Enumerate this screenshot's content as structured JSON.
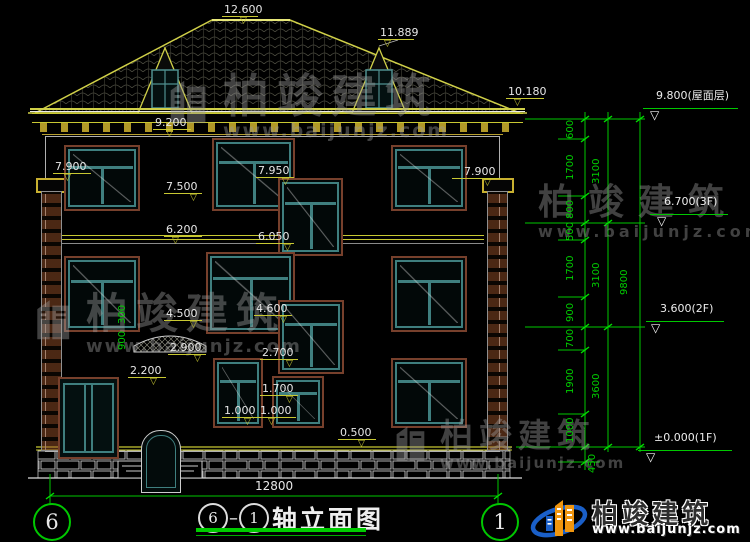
{
  "title": {
    "axis_left": "6",
    "axis_right": "1",
    "text": "轴立面图"
  },
  "bottom_dim": "12800",
  "axes": {
    "left": "6",
    "right": "1"
  },
  "watermark": {
    "brand": "柏竣建筑",
    "url": "www.baijunjz.com"
  },
  "logo": {
    "brand": "柏竣建筑",
    "url": "www.baijunjz.com"
  },
  "facade_marks": [
    {
      "v": "12.600",
      "x": 224,
      "y": 4,
      "x1": 222,
      "x2": 258,
      "ly": 16,
      "tx": 240
    },
    {
      "v": "11.889",
      "x": 380,
      "y": 27,
      "x1": 378,
      "x2": 414,
      "ly": 39,
      "tx": 384
    },
    {
      "v": "10.180",
      "x": 508,
      "y": 86,
      "x1": 506,
      "x2": 544,
      "ly": 98,
      "tx": 514
    },
    {
      "v": "9.200",
      "x": 155,
      "y": 117,
      "x1": 153,
      "x2": 191,
      "ly": 129,
      "tx": 166
    },
    {
      "v": "7.900",
      "x": 55,
      "y": 161,
      "x1": 53,
      "x2": 91,
      "ly": 173,
      "tx": 64
    },
    {
      "v": "7.500",
      "x": 166,
      "y": 181,
      "x1": 164,
      "x2": 202,
      "ly": 193,
      "tx": 190
    },
    {
      "v": "7.950",
      "x": 258,
      "y": 165,
      "x1": 256,
      "x2": 294,
      "ly": 177,
      "tx": 282
    },
    {
      "v": "7.900",
      "x": 464,
      "y": 166,
      "x1": 452,
      "x2": 500,
      "ly": 178,
      "tx": 484
    },
    {
      "v": "6.200",
      "x": 166,
      "y": 224,
      "x1": 164,
      "x2": 202,
      "ly": 236,
      "tx": 172
    },
    {
      "v": "6.050",
      "x": 258,
      "y": 231,
      "x1": 256,
      "x2": 294,
      "ly": 243,
      "tx": 284
    },
    {
      "v": "4.500",
      "x": 166,
      "y": 308,
      "x1": 164,
      "x2": 202,
      "ly": 320,
      "tx": 190
    },
    {
      "v": "4.600",
      "x": 256,
      "y": 303,
      "x1": 254,
      "x2": 292,
      "ly": 315,
      "tx": 280
    },
    {
      "v": "2.900",
      "x": 170,
      "y": 342,
      "x1": 168,
      "x2": 206,
      "ly": 354,
      "tx": 194
    },
    {
      "v": "2.700",
      "x": 262,
      "y": 347,
      "x1": 260,
      "x2": 298,
      "ly": 359,
      "tx": 286
    },
    {
      "v": "2.200",
      "x": 130,
      "y": 365,
      "x1": 128,
      "x2": 166,
      "ly": 377,
      "tx": 150
    },
    {
      "v": "1.700",
      "x": 262,
      "y": 383,
      "x1": 260,
      "x2": 298,
      "ly": 395,
      "tx": 286
    },
    {
      "v": "1.000",
      "x": 224,
      "y": 405,
      "x1": 222,
      "x2": 258,
      "ly": 417,
      "tx": 244
    },
    {
      "v": "1.000",
      "x": 260,
      "y": 405,
      "x1": 258,
      "x2": 296,
      "ly": 417,
      "tx": 268
    },
    {
      "v": "0.500",
      "x": 340,
      "y": 427,
      "x1": 338,
      "x2": 376,
      "ly": 439,
      "tx": 358
    }
  ],
  "levels_right": [
    {
      "v": "9.800(屋面层)",
      "x": 656,
      "y": 90,
      "x1": 643,
      "x2": 738,
      "ly": 108,
      "tx": 650
    },
    {
      "v": "6.700(3F)",
      "x": 664,
      "y": 196,
      "x1": 650,
      "x2": 728,
      "ly": 214,
      "tx": 657
    },
    {
      "v": "3.600(2F)",
      "x": 660,
      "y": 303,
      "x1": 646,
      "x2": 724,
      "ly": 321,
      "tx": 651
    },
    {
      "v": "±0.000(1F)",
      "x": 654,
      "y": 432,
      "x1": 638,
      "x2": 732,
      "ly": 450,
      "tx": 646
    }
  ],
  "ladder_dims": [
    {
      "v": "600",
      "x": 572,
      "y": 129
    },
    {
      "v": "1700",
      "x": 572,
      "y": 167
    },
    {
      "v": "800",
      "x": 572,
      "y": 209
    },
    {
      "v": "500",
      "x": 572,
      "y": 231
    },
    {
      "v": "1700",
      "x": 572,
      "y": 268
    },
    {
      "v": "900",
      "x": 572,
      "y": 312
    },
    {
      "v": "700",
      "x": 572,
      "y": 338
    },
    {
      "v": "1900",
      "x": 572,
      "y": 381
    },
    {
      "v": "1000",
      "x": 572,
      "y": 430
    },
    {
      "v": "450",
      "x": 594,
      "y": 463
    },
    {
      "v": "3100",
      "x": 598,
      "y": 171
    },
    {
      "v": "3100",
      "x": 598,
      "y": 275
    },
    {
      "v": "3600",
      "x": 598,
      "y": 386
    },
    {
      "v": "9800",
      "x": 626,
      "y": 282
    },
    {
      "v": "300",
      "x": 124,
      "y": 314
    },
    {
      "v": "900",
      "x": 124,
      "y": 340
    }
  ],
  "colors": {
    "background": "#000000",
    "line_yellow": "#c8c832",
    "line_green": "#00c800",
    "frame_teal": "#3f7f7f",
    "frame_brown": "#77402c",
    "watermark_gray": "#9c9c9c",
    "logo_blue": "#1a5fc8",
    "logo_orange": "#f0960f"
  }
}
